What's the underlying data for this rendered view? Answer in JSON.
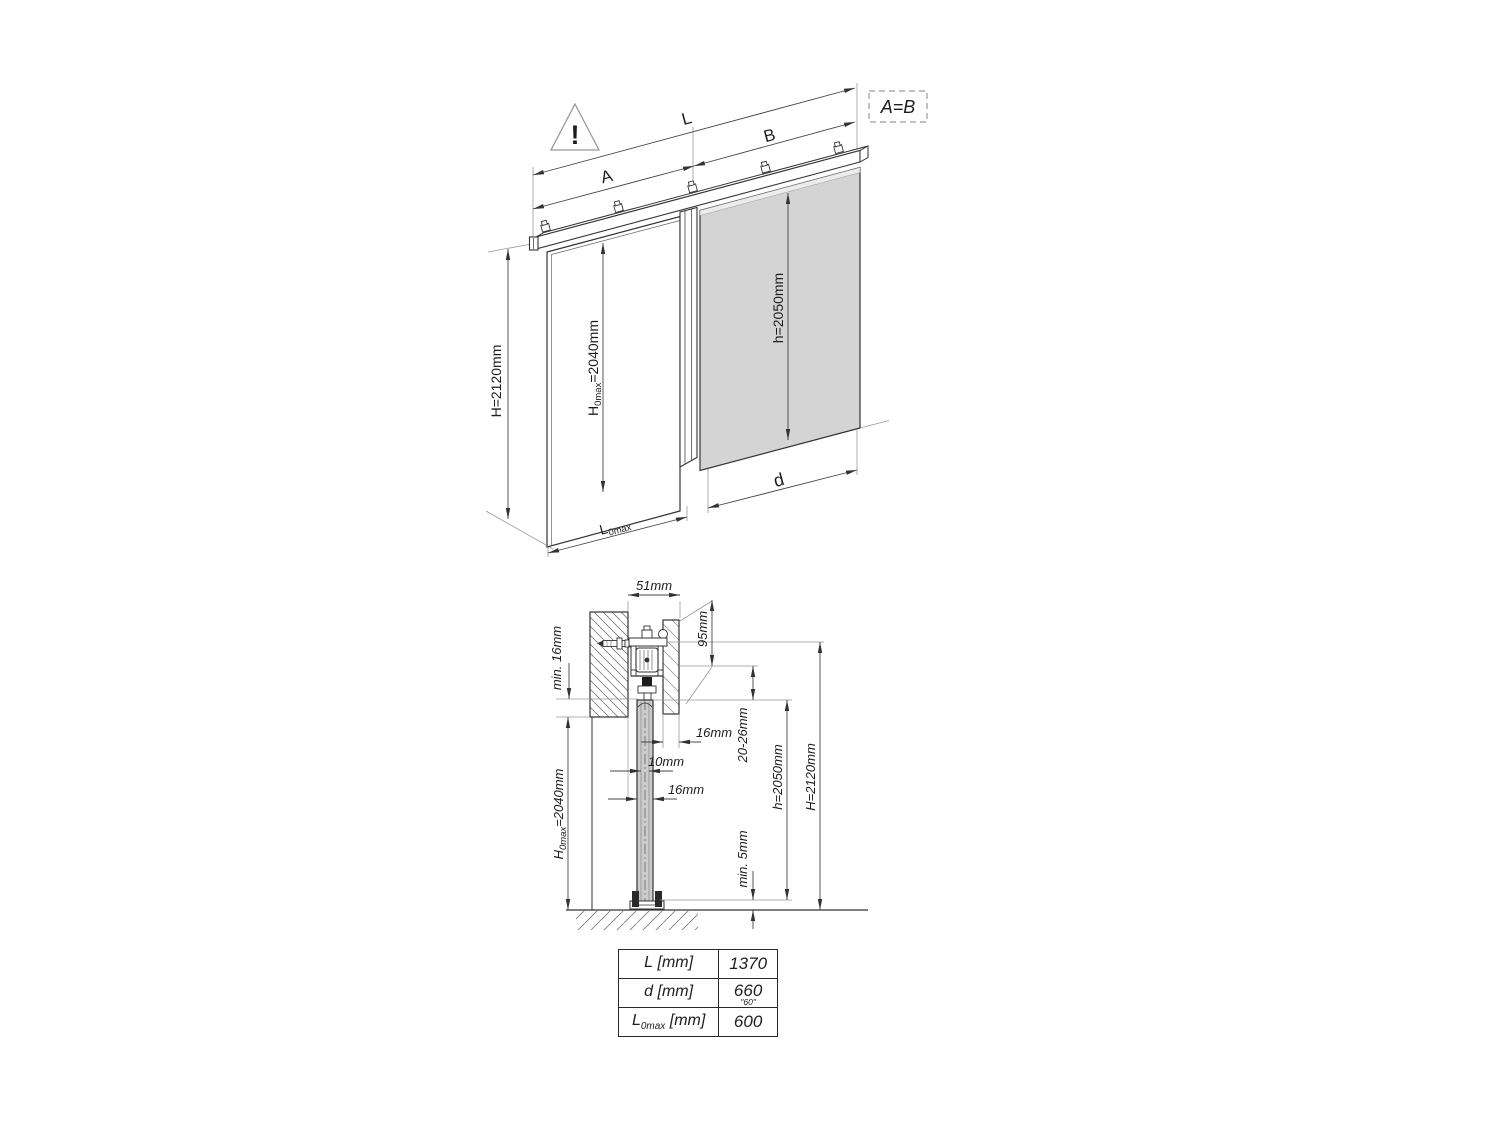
{
  "iso": {
    "warning": "!",
    "label_L": "L",
    "label_A": "A",
    "label_B": "B",
    "equality": "A=B",
    "dim_H": "H=2120mm",
    "dim_H0": {
      "base": "H",
      "sub": "0max",
      "rest": "=2040mm"
    },
    "dim_h": "h=2050mm",
    "label_d": "d",
    "dim_L0": {
      "base": "L",
      "sub": "0max"
    }
  },
  "section": {
    "dim_51": "51mm",
    "dim_95": "95mm",
    "dim_min16": "min. 16mm",
    "dim_16_fascia": "16mm",
    "dim_10": "10mm",
    "dim_16_door": "16mm",
    "dim_2026": "20-26mm",
    "dim_h": "h=2050mm",
    "dim_H": "H=2120mm",
    "dim_H0": {
      "base": "H",
      "sub": "0max",
      "rest": "=2040mm"
    },
    "dim_min5": "min. 5mm"
  },
  "table": {
    "rows": [
      {
        "label_base": "L",
        "label_sub": "",
        "label_rest": " [mm]",
        "value": "1370",
        "note": ""
      },
      {
        "label_base": "d",
        "label_sub": "",
        "label_rest": " [mm]",
        "value": "660",
        "note": "\"60\""
      },
      {
        "label_base": "L",
        "label_sub": "0max",
        "label_rest": " [mm]",
        "value": "600",
        "note": ""
      }
    ]
  },
  "colors": {
    "door_gray": "#d4d4d4",
    "line_dark": "#2a2a2a",
    "dim_line": "#444444"
  }
}
